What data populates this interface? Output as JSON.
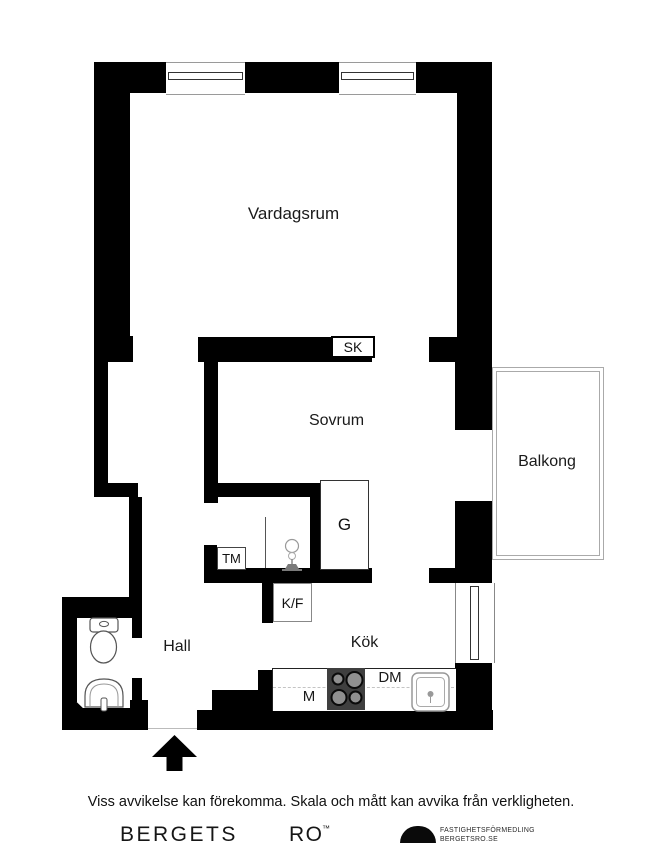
{
  "plan": {
    "rooms": {
      "living": "Vardagsrum",
      "bedroom": "Sovrum",
      "balcony": "Balkong",
      "hall": "Hall",
      "kitchen": "Kök"
    },
    "fixtures": {
      "sk": "SK",
      "g": "G",
      "tm": "TM",
      "kf": "K/F",
      "dm": "DM",
      "m": "M"
    }
  },
  "footer": {
    "disclaimer": "Viss avvikelse kan förekomma. Skala och mått kan avvika från verkligheten.",
    "brand_left": "BERGETS",
    "brand_right": "RO",
    "trademark": "™",
    "agency_line1": "FASTIGHETSFÖRMEDLING",
    "agency_line2": "BERGETSRO.SE"
  },
  "colors": {
    "wall": "#000000",
    "background": "#ffffff",
    "stove_body": "#3f3f3f",
    "burner": "#8f8f8f",
    "fixture_outline": "#555555",
    "balcony_outline": "#aaaaaa"
  }
}
